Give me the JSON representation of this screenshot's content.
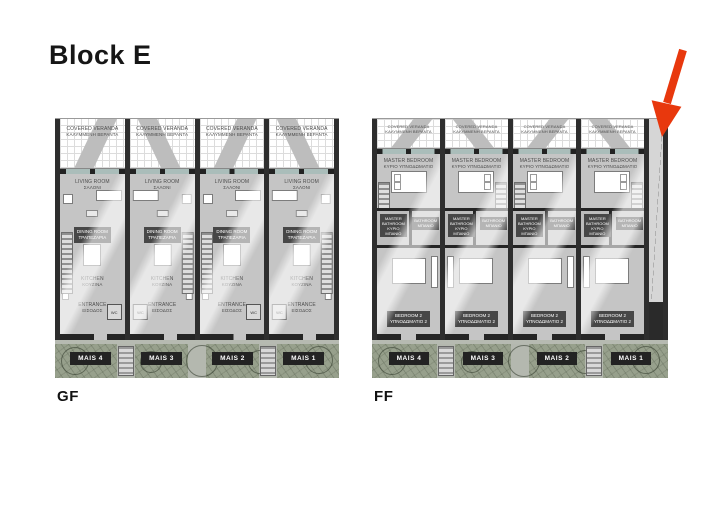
{
  "page": {
    "title": "Block E"
  },
  "plans": [
    {
      "caption": "GF",
      "units": [
        {
          "label": "MAIS 4"
        },
        {
          "label": "MAIS 3"
        },
        {
          "label": "MAIS 2"
        },
        {
          "label": "MAIS 1"
        }
      ],
      "rooms": {
        "veranda_en": "COVERED VERANDA",
        "veranda_gr": "ΚΑΛΥΜΜΕΝΗ ΒΕΡΑΝΤΑ",
        "living_en": "LIVING ROOM",
        "living_gr": "ΣΑΛΟΝΙ",
        "dining_en": "DINING ROOM",
        "dining_gr": "ΤΡΑΠΕΖΑΡΙΑ",
        "kitchen_en": "KITCHEN",
        "kitchen_gr": "ΚΟΥΖΙΝΑ",
        "entrance_en": "ENTRANCE",
        "entrance_gr": "ΕΙΣΟΔΟΣ",
        "wc": "WC"
      }
    },
    {
      "caption": "FF",
      "units": [
        {
          "label": "MAIS 4"
        },
        {
          "label": "MAIS 3"
        },
        {
          "label": "MAIS 2"
        },
        {
          "label": "MAIS 1"
        }
      ],
      "rooms": {
        "veranda_en": "COVERED VERANDA",
        "veranda_gr": "ΚΑΛΥΜΜΕΝΗ ΒΕΡΑΝΤΑ",
        "master_en": "MASTER BEDROOM",
        "master_gr": "ΚΥΡΙΟ ΥΠΝΟΔΩΜΑΤΙΟ",
        "mbath_en": "MASTER BATHROOM",
        "mbath_gr": "ΚΥΡΙΟ ΜΠΑΝΙΟ",
        "bath_en": "BATHROOM",
        "bath_gr": "ΜΠΑΝΙΟ",
        "bed2_en": "BEDROOM 2",
        "bed2_gr": "ΥΠΝΟΔΩΜΑΤΙΟ 2"
      }
    }
  ],
  "colors": {
    "floor": "#c5c5c5",
    "wall": "#2e2e2e",
    "landscape": "#97a08c",
    "badge": "#232323",
    "arrow": "#e8380d"
  }
}
